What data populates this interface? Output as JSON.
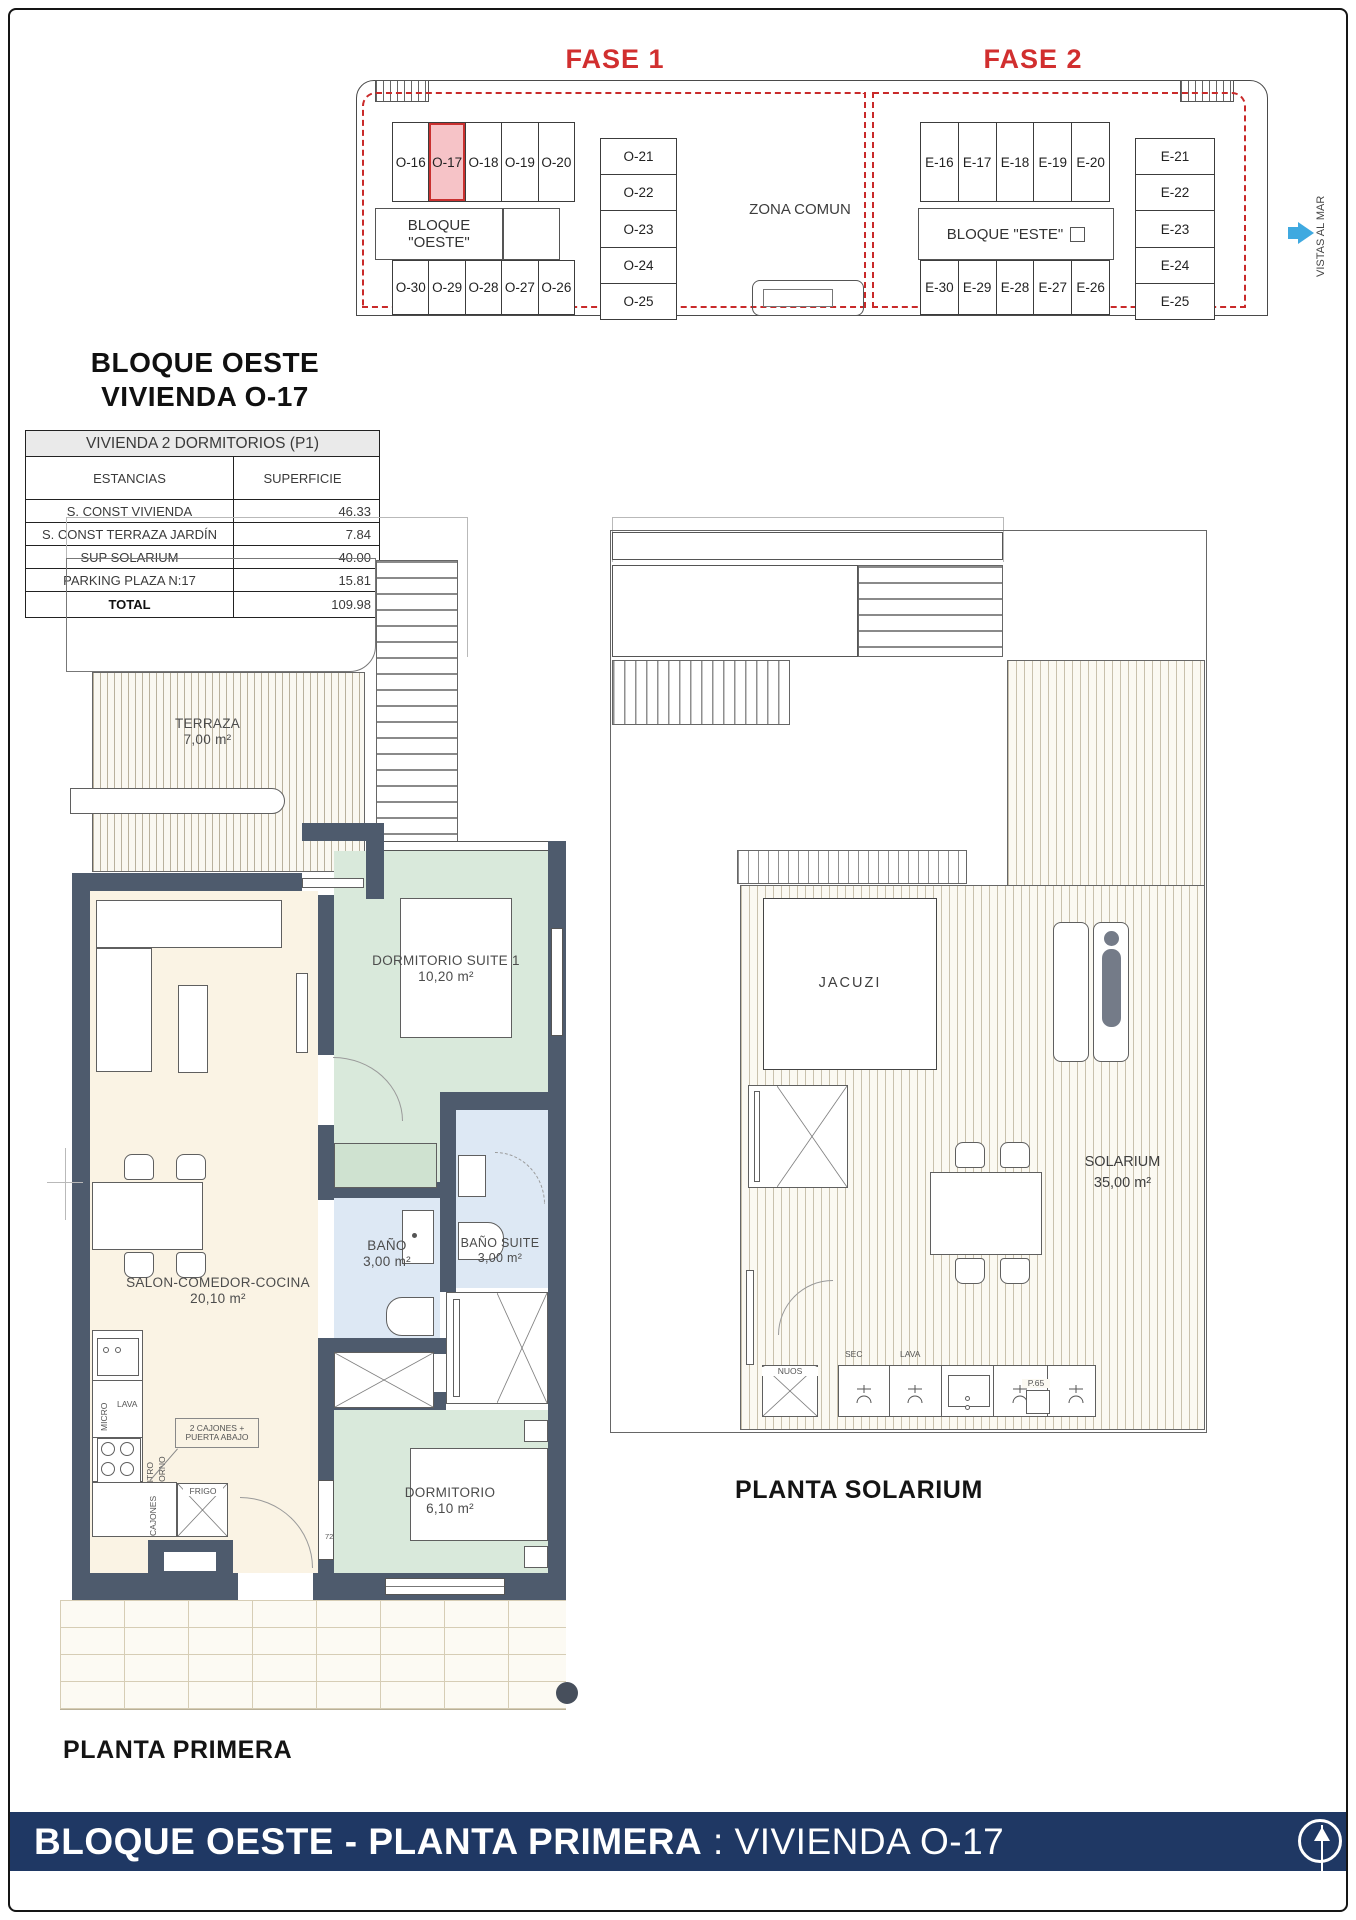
{
  "colors": {
    "accent_red": "#d12f2f",
    "highlight_pink": "#f6c3c7",
    "wall_slate": "#4e5b6d",
    "footer_navy": "#1f3864",
    "sea_arrow_blue": "#3fa9e0",
    "entrance_blue": "#45a8de"
  },
  "site_plan": {
    "fase1": "FASE 1",
    "fase2": "FASE 2",
    "zona_comun": "ZONA COMUN",
    "bloque_oeste_line1": "BLOQUE",
    "bloque_oeste_line2": "\"OESTE\"",
    "bloque_este": "BLOQUE \"ESTE\"",
    "vistas_al_mar": "VISTAS AL MAR",
    "oeste_top": [
      "O-16",
      "O-17",
      "O-18",
      "O-19",
      "O-20"
    ],
    "oeste_bottom": [
      "O-30",
      "O-29",
      "O-28",
      "O-27",
      "O-26"
    ],
    "oeste_right": [
      "O-21",
      "O-22",
      "O-23",
      "O-24",
      "O-25"
    ],
    "este_top": [
      "E-16",
      "E-17",
      "E-18",
      "E-19",
      "E-20"
    ],
    "este_bottom": [
      "E-30",
      "E-29",
      "E-28",
      "E-27",
      "E-26"
    ],
    "este_right": [
      "E-21",
      "E-22",
      "E-23",
      "E-24",
      "E-25"
    ]
  },
  "info": {
    "title1": "BLOQUE OESTE",
    "title2": "VIVIENDA O-17",
    "table": {
      "header": "VIVIENDA 2 DORMITORIOS (P1)",
      "col_estancias": "ESTANCIAS",
      "col_superficie": "SUPERFICIE",
      "rows": [
        {
          "label": "S. CONST VIVIENDA",
          "value": "46.33"
        },
        {
          "label": "S. CONST TERRAZA JARDÍN",
          "value": "7.84"
        },
        {
          "label": "SUP SOLARIUM",
          "value": "40.00"
        },
        {
          "label": "PARKING   PLAZA   N:17",
          "value": "15.81"
        }
      ],
      "total_label": "TOTAL",
      "total_value": "109.98"
    }
  },
  "primera": {
    "heading": "PLANTA PRIMERA",
    "terraza_name": "TERRAZA",
    "terraza_area": "7,00 m²",
    "suite_name": "DORMITORIO SUITE 1",
    "suite_area": "10,20 m²",
    "salon_name": "SALON-COMEDOR-COCINA",
    "salon_area": "20,10 m²",
    "bano_name": "BAÑO",
    "bano_area": "3,00 m²",
    "bano_suite_name": "BAÑO SUITE",
    "bano_suite_area": "3,00 m²",
    "dorm_name": "DORMITORIO",
    "dorm_area": "6,10 m²",
    "kitchen": {
      "micro": "MICRO",
      "lava": "LAVA",
      "vitro": "VITRO",
      "horno": "HORNO",
      "cajones": "CAJONES",
      "frigo": "FRIGO",
      "callout1": "2 CAJONES +",
      "callout2": "PUERTA ABAJO"
    },
    "door_number": "72",
    "entrance_label": "O-17"
  },
  "solarium": {
    "heading": "PLANTA SOLARIUM",
    "jacuzi": "JACUZI",
    "name": "SOLARIUM",
    "area": "35,00 m²",
    "nuos": "NUOS",
    "sec": "SEC",
    "lava": "LAVA",
    "p65": "P.65"
  },
  "footer": {
    "bold": "BLOQUE OESTE - PLANTA PRIMERA",
    "sep": " : ",
    "regular": "VIVIENDA O-17"
  }
}
